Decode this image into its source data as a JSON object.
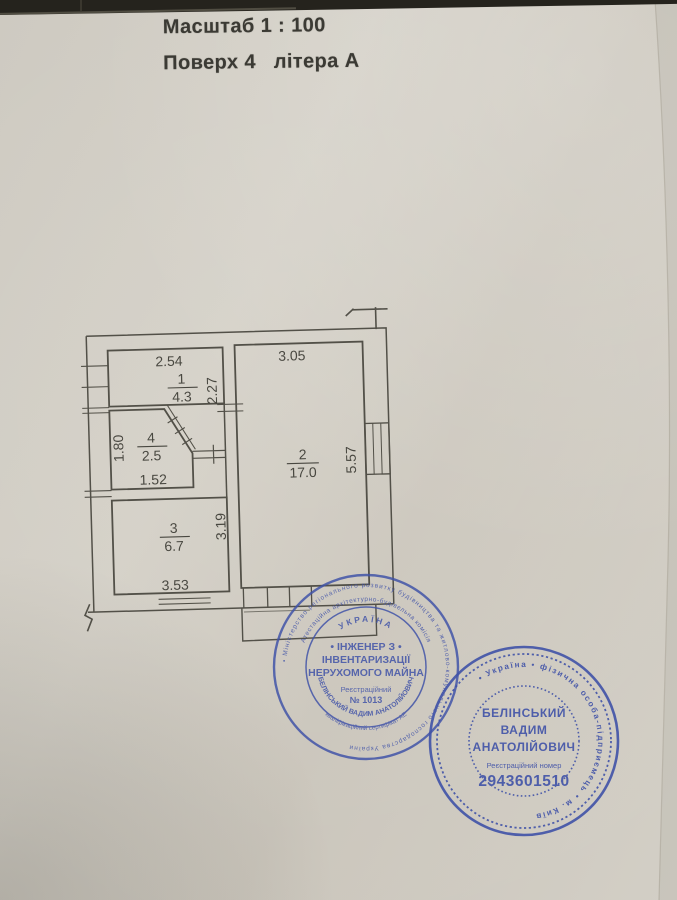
{
  "header": {
    "scale": "Масштаб 1 : 100",
    "floor": "Поверх 4   літера А"
  },
  "plan": {
    "rooms": [
      {
        "number": "1",
        "area": "4.3"
      },
      {
        "number": "2",
        "area": "17.0"
      },
      {
        "number": "3",
        "area": "6.7"
      },
      {
        "number": "4",
        "area": "2.5"
      }
    ],
    "dims": {
      "d254": "2.54",
      "d305": "3.05",
      "d227": "2.27",
      "d557": "5.57",
      "d180": "1.80",
      "d152": "1.52",
      "d319": "3.19",
      "d353": "3.53"
    }
  },
  "stamps": {
    "ink_color": "#4052a8",
    "engineer": {
      "ring_outer": "• Міністерство регіонального розвитку будівництва та житлово-комунального господарства України",
      "ring_inner": "Атестаційна архітектурно-будівельна комісія",
      "country": "УКРАЇНА",
      "title1": "• ІНЖЕНЕР З •",
      "title2": "ІНВЕНТАРИЗАЦІЇ",
      "title3": "НЕРУХОМОГО МАЙНА",
      "reg_label": "Реєстраційний",
      "reg_number": "№ 1013",
      "name_arc": "БЕЛІНСЬКИЙ ВАДИМ АНАТОЛІЙОВИЧ",
      "cert_arc": "кваліфікаційний сертифікат АЕ"
    },
    "fop": {
      "ring": "• Україна • фізична особа-підприємець • м. Київ",
      "name1": "БЕЛІНСЬКИЙ",
      "name2": "ВАДИМ",
      "name3": "АНАТОЛІЙОВИЧ",
      "reg_label": "Реєстраційний номер",
      "reg_number": "2943601510"
    }
  }
}
